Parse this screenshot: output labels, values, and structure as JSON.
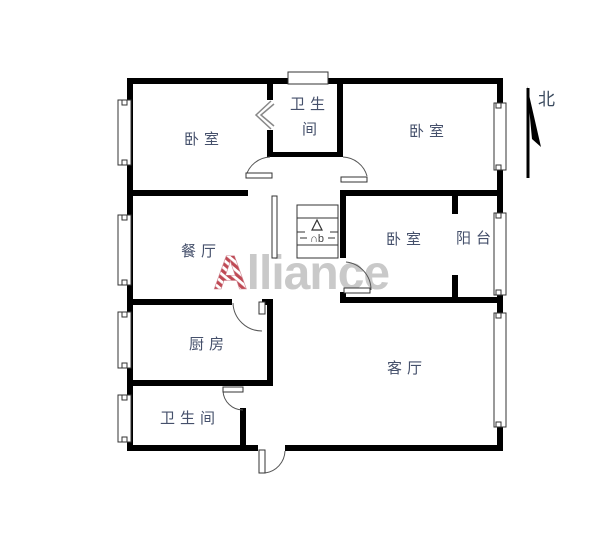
{
  "title": "apartment-floor-plan",
  "rooms": {
    "bedroom_top_left": "卧室",
    "bathroom_top_line1": "卫生",
    "bathroom_top_line2": "间",
    "bedroom_top_right": "卧室",
    "dining": "餐厅",
    "bedroom_middle": "卧室",
    "balcony": "阳台",
    "kitchen": "厨房",
    "living": "客厅",
    "bathroom_bottom": "卫生间"
  },
  "compass": {
    "label": "北"
  },
  "stairs": {
    "label": "∩b"
  },
  "watermark": {
    "first_letter": "A",
    "rest": "lliance",
    "full_text": "Alliance"
  },
  "colors": {
    "wall": "#000000",
    "room_label": "#45506b",
    "compass_label": "#3a4a5e",
    "watermark_letter": "#bf4a55",
    "watermark_rest": "#c9c9c9",
    "background": "#ffffff",
    "door_line": "#555555"
  }
}
